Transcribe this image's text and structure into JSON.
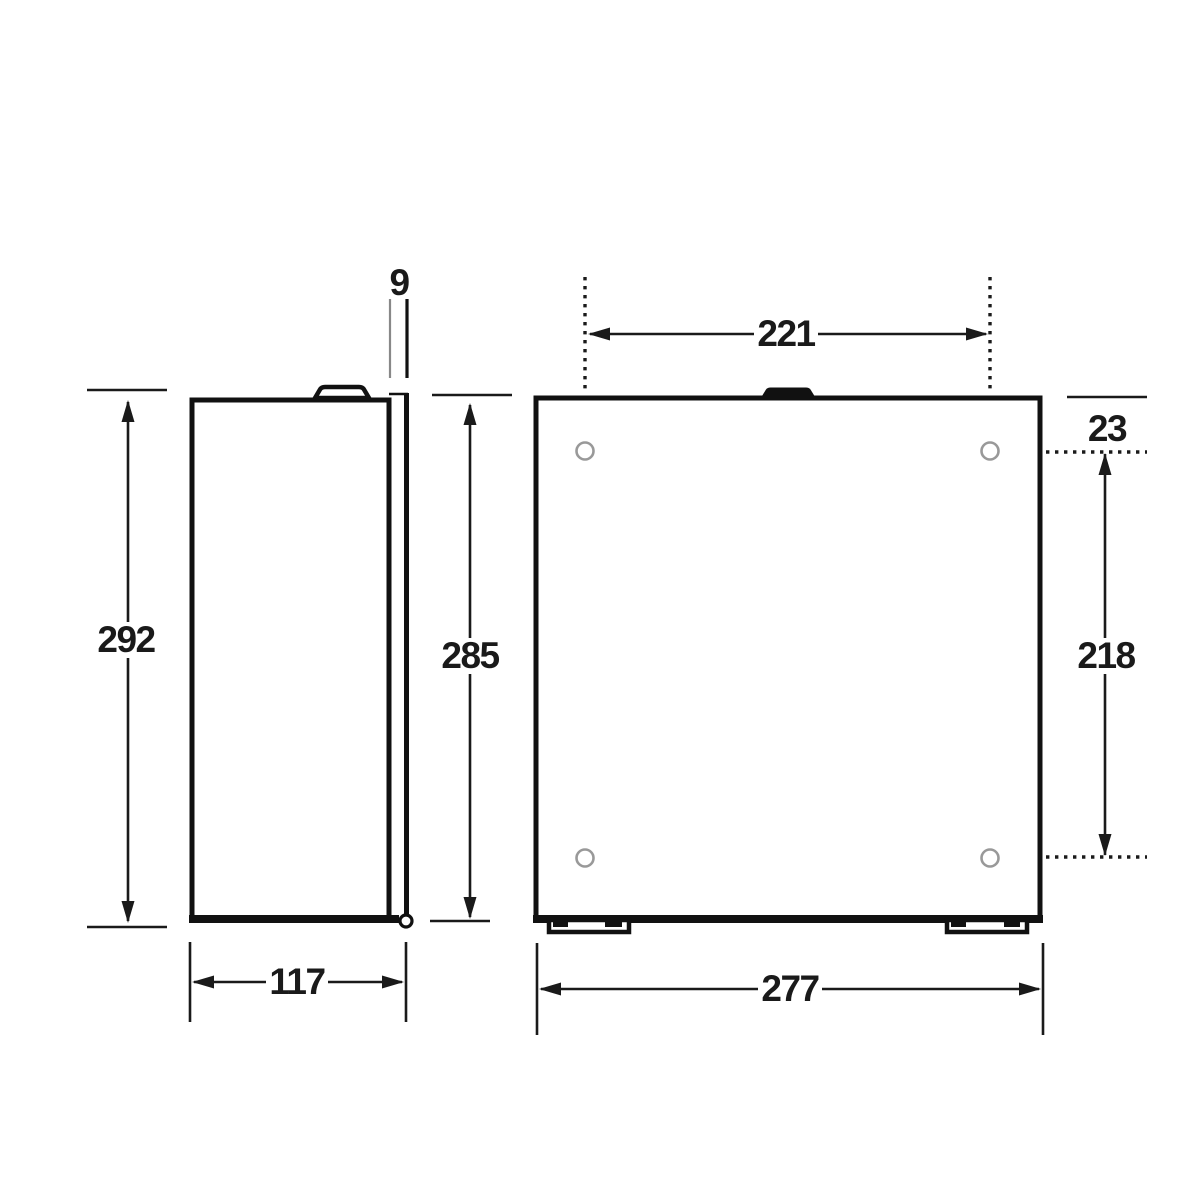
{
  "diagram": {
    "colors": {
      "line": "#1a1a1a",
      "hole_outline": "#999999",
      "background": "#ffffff"
    },
    "side_view": {
      "dimensions": {
        "door_thickness": {
          "label": "9"
        },
        "overall_height": {
          "label": "292"
        },
        "body_height": {
          "label": "285"
        },
        "depth": {
          "label": "117"
        }
      }
    },
    "front_view": {
      "hole_count": 4,
      "dimensions": {
        "hole_spacing_horizontal": {
          "label": "221"
        },
        "hole_offset_top": {
          "label": "23"
        },
        "hole_spacing_vertical": {
          "label": "218"
        },
        "overall_width": {
          "label": "277"
        }
      }
    }
  }
}
